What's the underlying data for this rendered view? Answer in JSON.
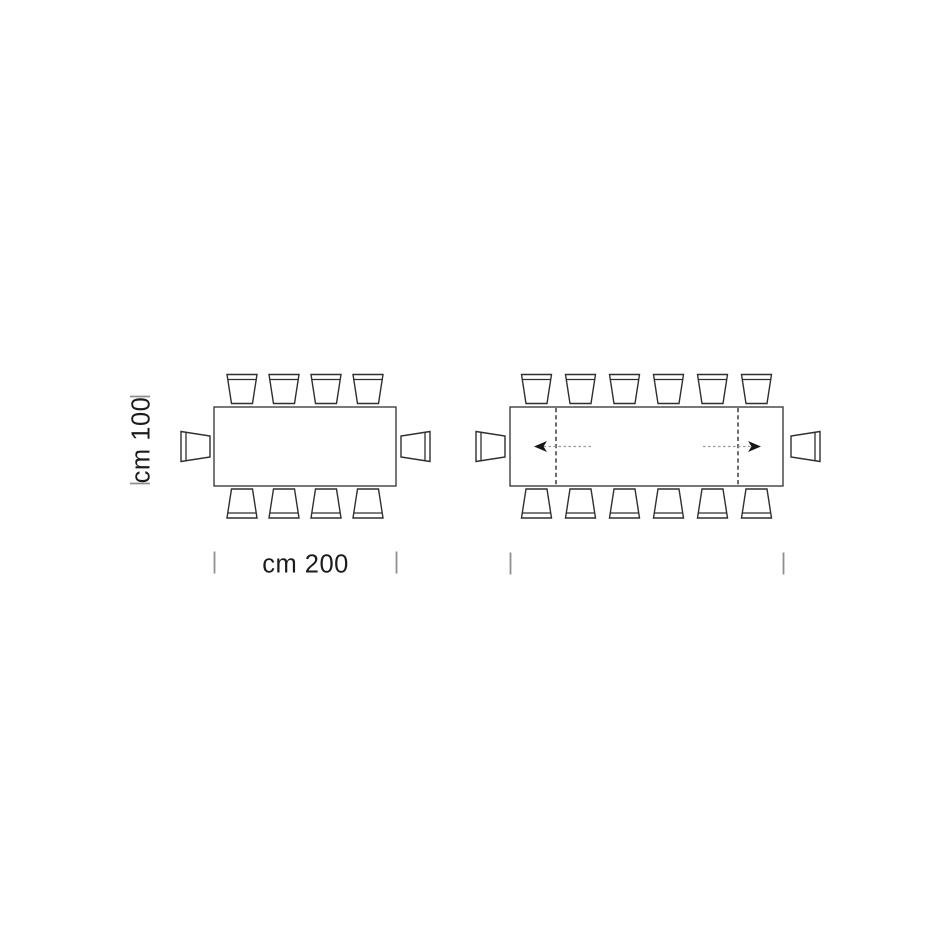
{
  "page": {
    "background": "#ffffff"
  },
  "diagram": {
    "title": "dining-table-dimensions-top-view",
    "labels": {
      "width": "cm 200",
      "height": "cm 100"
    },
    "colors": {
      "background": "#ffffff",
      "line": "#2f2f2f",
      "tick": "#8f8f8f",
      "text": "#1c1c1c",
      "arrow_line": "#9c9c9c",
      "arrow_head": "#161616"
    },
    "tables": [
      {
        "id": "table-closed",
        "name": "closed-table",
        "seats": {
          "top": 4,
          "bottom": 4,
          "left": 1,
          "right": 1
        },
        "extended": false
      },
      {
        "id": "table-extended",
        "name": "extended-table",
        "seats": {
          "top": 6,
          "bottom": 6,
          "left": 1,
          "right": 1
        },
        "extended": true,
        "extension_leaf_lines": 2,
        "extension_arrows": [
          "left",
          "right"
        ]
      }
    ]
  }
}
